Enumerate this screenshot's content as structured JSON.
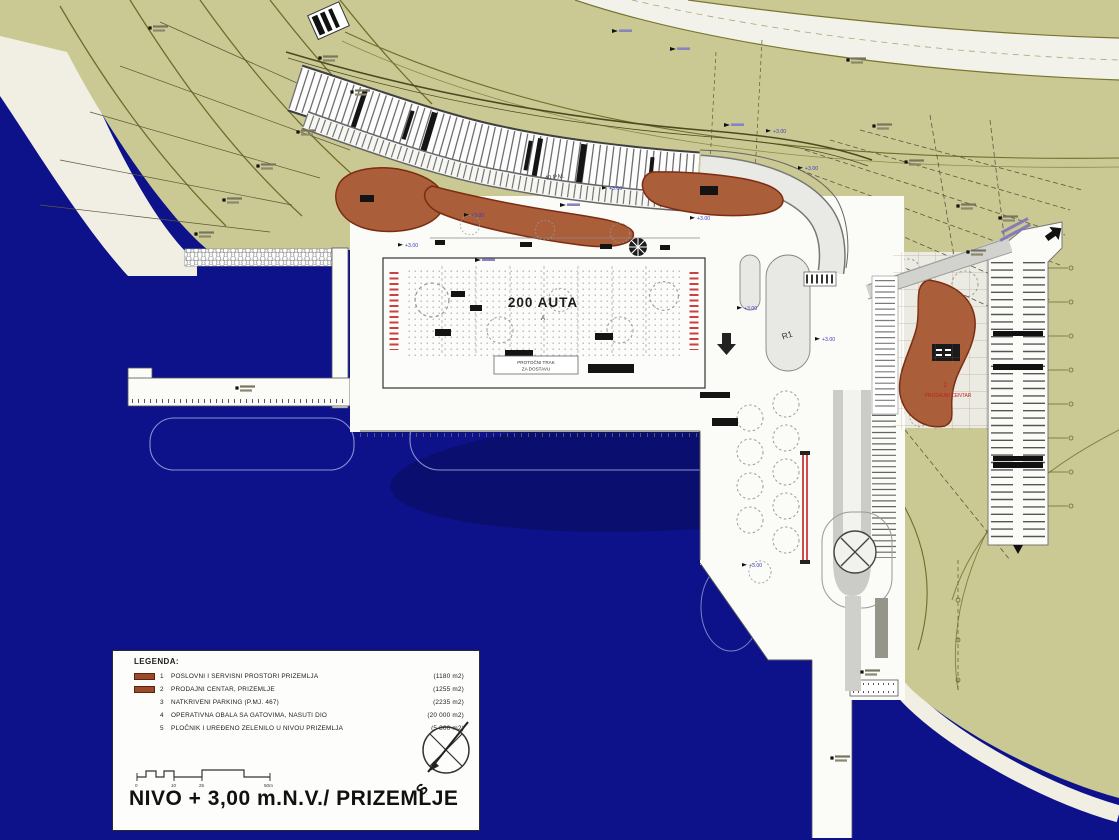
{
  "plan": {
    "title": "NIVO + 3,00 m.N.V./ PRIZEMLJE",
    "parking_count_label": "200 AUTA",
    "parking_row_marker": "A",
    "arcade_parking_label": "40 P.M.",
    "road_marker": "R1",
    "service_lane_label_line1": "PROTOČNI TRAK",
    "service_lane_label_line2": "ZA DOSTAVU",
    "retail_marker_num": "2",
    "retail_label": "PRODAJNI CENTAR",
    "spot_elevation_label": "+3.00",
    "compass_north_letter": "S"
  },
  "legend": {
    "title": "LEGENDA:",
    "items": [
      {
        "num": "1",
        "label": "POSLOVNI I SERVISNI PROSTORI PRIZEMLJA",
        "area": "(1180 m2)"
      },
      {
        "num": "2",
        "label": "PRODAJNI CENTAR, PRIZEMLJE",
        "area": "(1255 m2)"
      },
      {
        "num": "3",
        "label": "NATKRIVENI PARKING  (P.MJ. 467)",
        "area": "(2235 m2)"
      },
      {
        "num": "4",
        "label": "OPERATIVNA OBALA SA GATOVIMA, NASUTI DIO",
        "area": "(20 000 m2)"
      },
      {
        "num": "5",
        "label": "PLOČNIK I UREĐENO ZELENILO U NIVOU PRIZEMLJA",
        "area": "(5 800 m2)"
      }
    ],
    "scale_ticks": [
      "0",
      "10",
      "25",
      "50m"
    ]
  },
  "colors": {
    "sea": "#0d128a",
    "land_olive": "#cbc993",
    "plan_white": "#fbfbf8",
    "building_brown": "#ab5e3a",
    "legend_swatch": "#9b4a2a",
    "accent_red": "#c42020",
    "spot_label_blue": "#3d3dc0"
  }
}
